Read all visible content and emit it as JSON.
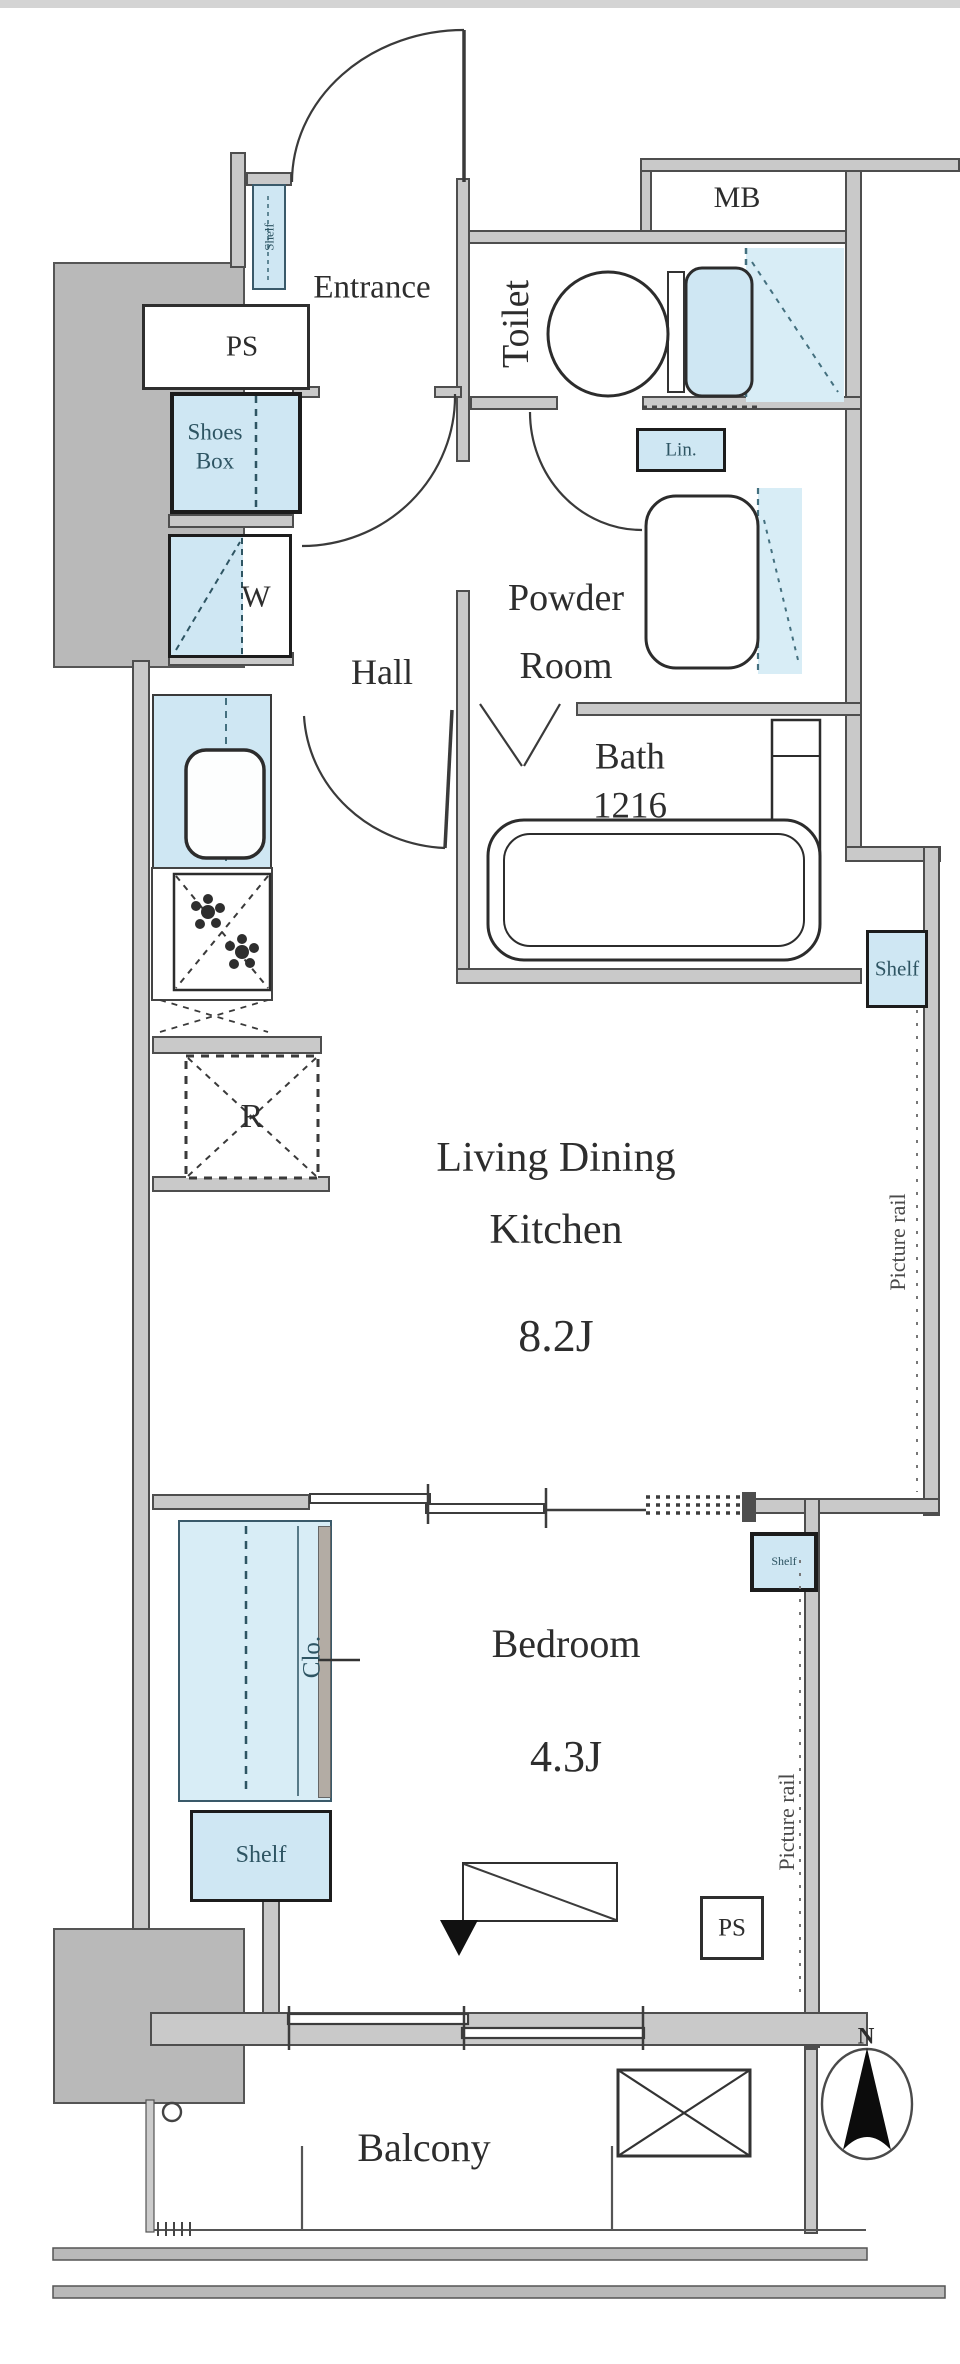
{
  "rooms": {
    "entrance": {
      "label": "Entrance"
    },
    "toilet": {
      "label": "Toilet"
    },
    "powder_room": {
      "line1": "Powder",
      "line2": "Room"
    },
    "bath": {
      "label": "Bath",
      "size": "1216"
    },
    "hall": {
      "label": "Hall"
    },
    "ldk": {
      "line1": "Living Dining",
      "line2": "Kitchen",
      "size": "8.2J"
    },
    "bedroom": {
      "label": "Bedroom",
      "size": "4.3J"
    },
    "balcony": {
      "label": "Balcony"
    },
    "closet": {
      "label": "Clo."
    }
  },
  "storage": {
    "ps_top": "PS",
    "ps_bottom": "PS",
    "meter_box": "MB",
    "shoes_box": {
      "line1": "Shoes",
      "line2": "Box"
    },
    "entrance_shelf": "Shelf",
    "linen": "Lin.",
    "ldk_shelf": "Shelf",
    "partition_shelf": "Shelf",
    "bedroom_shelf": "Shelf",
    "washer": "W",
    "refrigerator": "R"
  },
  "annotations": {
    "picture_rail_ldk": "Picture rail",
    "picture_rail_bedroom": "Picture rail",
    "north": "N"
  },
  "colors": {
    "fixture_blue": "#cfe7f3",
    "floor_blue": "#d8edf6",
    "wall_gray": "#c9c9c9",
    "line_dark": "#3c3c3c"
  }
}
